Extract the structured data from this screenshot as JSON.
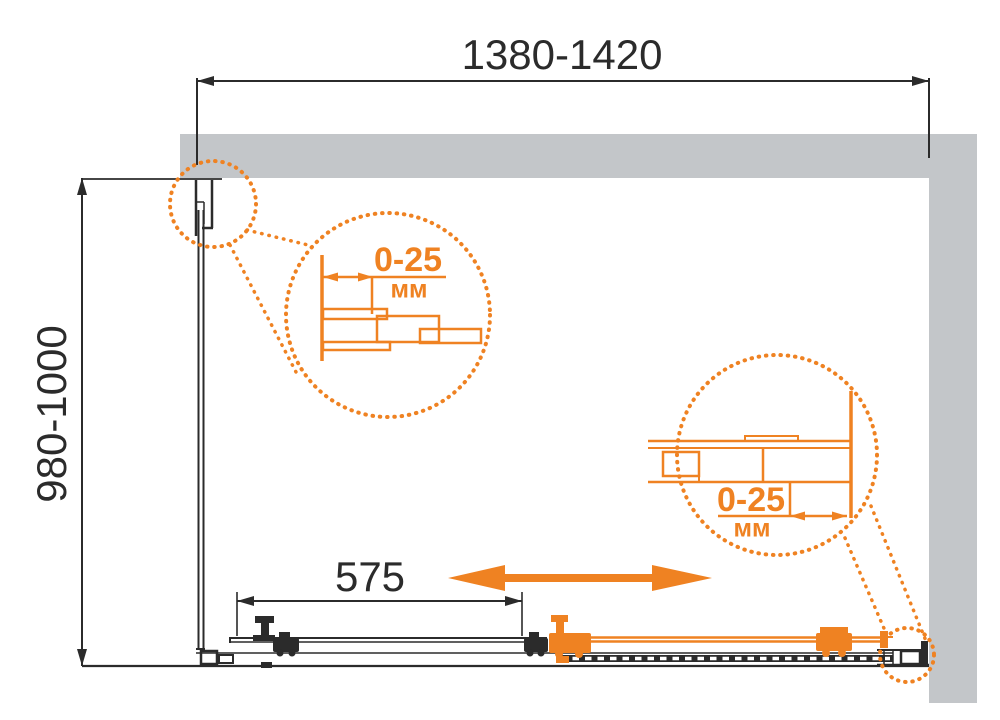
{
  "diagram": {
    "width_label": "1380-1420",
    "depth_label": "980-1000",
    "door_label": "575",
    "detail_left": {
      "range": "0-25",
      "unit": "мм"
    },
    "detail_right": {
      "range": "0-25",
      "unit": "мм"
    },
    "colors": {
      "accent_orange": "#ef8222",
      "wall_gray": "#c3c6c9",
      "line_black": "#2b2b2b"
    }
  }
}
